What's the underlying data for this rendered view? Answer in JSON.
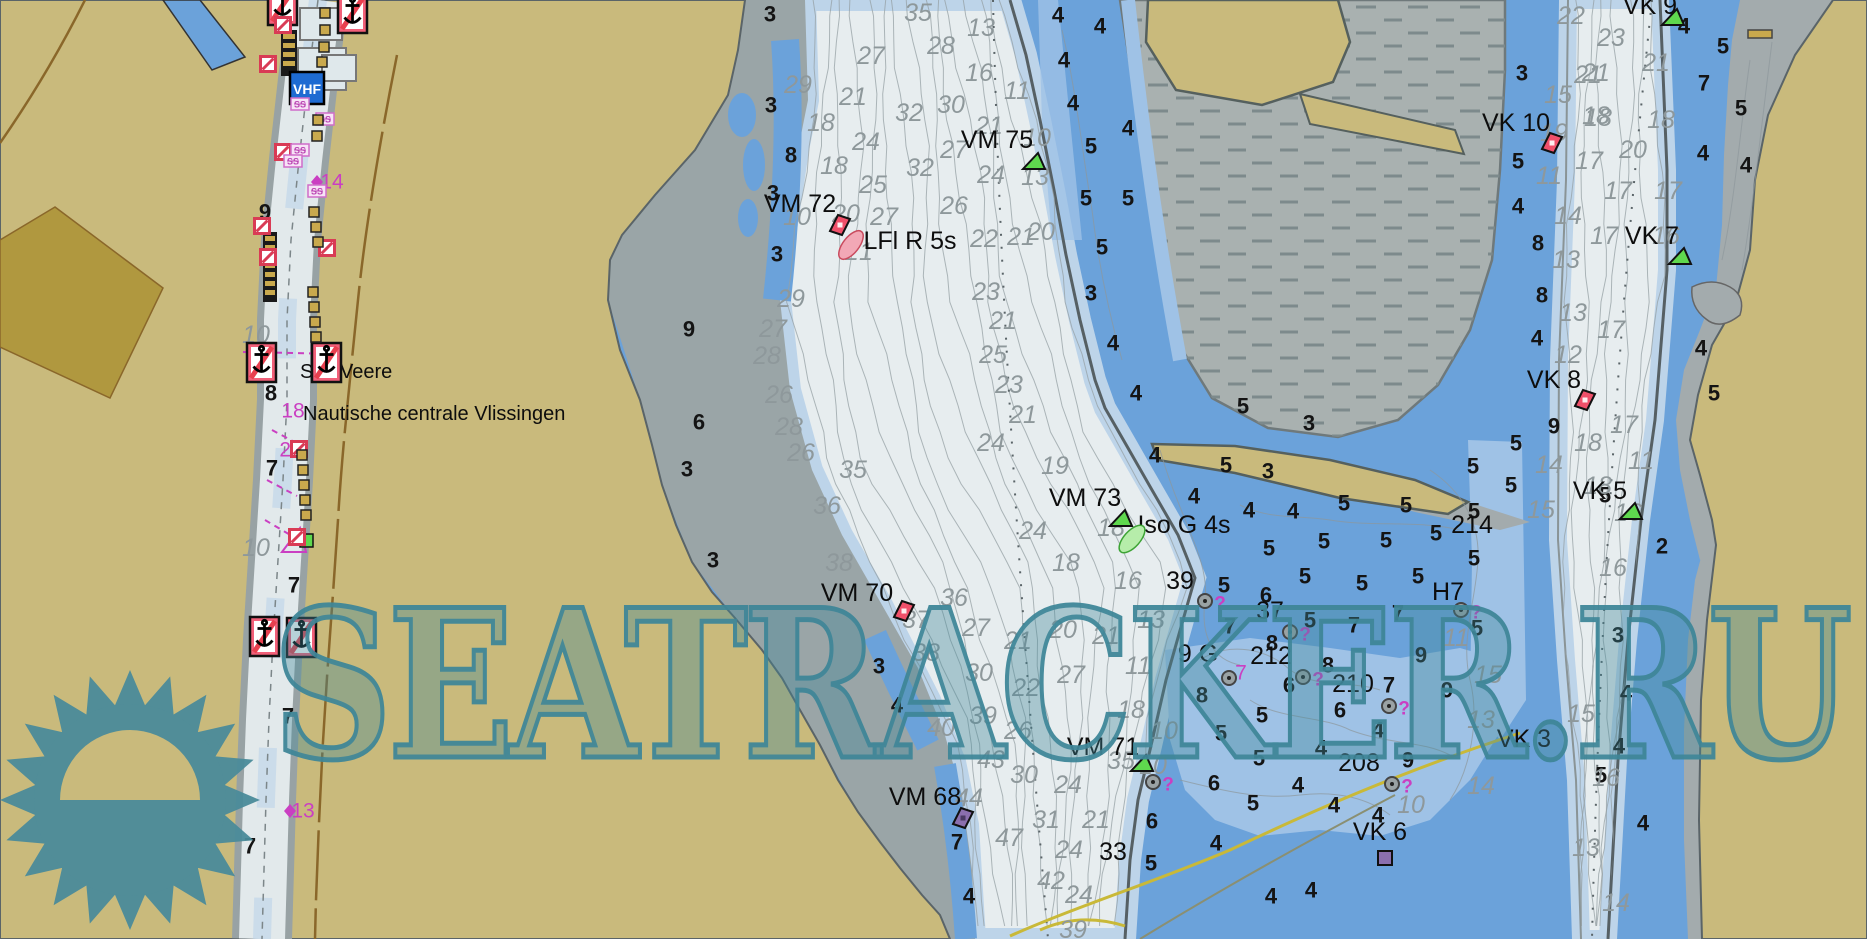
{
  "app": {
    "type": "nautical-chart-viewer"
  },
  "watermark": {
    "text": "SEATRACKER.RU",
    "color": "#3e8698"
  },
  "texts": {
    "vhf": "VHF",
    "ss": "SS"
  },
  "colors": {
    "land": "#c9ba7c",
    "land_dark": "#b0983f",
    "road": "#8a672a",
    "water_deep": "#e7edef",
    "water_shallow": "#6ba2da",
    "water_mid": "#9fc2e6",
    "water_light": "#bdd4e9",
    "flat_gray": "#a9b1b0",
    "bank_gray": "#9aa5a7",
    "magenta": "#ca3fc2",
    "buoy_red": "#f0506a",
    "buoy_green": "#5fd84e",
    "buoy_purple": "#8b6fae",
    "sign_red": "#f26079",
    "vhf_blue": "#1e6bd2",
    "gold": "#c9a94d",
    "teal": "#3e8698"
  },
  "nav_labels": [
    {
      "t": "VM 72",
      "x": 800,
      "y": 204
    },
    {
      "t": "LFl R 5s",
      "x": 910,
      "y": 241
    },
    {
      "t": "VM 75",
      "x": 997,
      "y": 140
    },
    {
      "t": "VM 73",
      "x": 1085,
      "y": 498
    },
    {
      "t": "Iso G 4s",
      "x": 1184,
      "y": 525
    },
    {
      "t": "VM 70",
      "x": 857,
      "y": 593
    },
    {
      "t": "VM 71",
      "x": 1103,
      "y": 747
    },
    {
      "t": "VM 68",
      "x": 925,
      "y": 797
    },
    {
      "t": "VK 10",
      "x": 1516,
      "y": 123
    },
    {
      "t": "VK 9",
      "x": 1650,
      "y": 6
    },
    {
      "t": "VK 7",
      "x": 1652,
      "y": 236
    },
    {
      "t": "VK 8",
      "x": 1554,
      "y": 380
    },
    {
      "t": "VK 5",
      "x": 1600,
      "y": 491
    },
    {
      "t": "VK 3",
      "x": 1524,
      "y": 739
    },
    {
      "t": "VK 6",
      "x": 1380,
      "y": 832
    },
    {
      "t": "H7",
      "x": 1448,
      "y": 592
    },
    {
      "t": "214",
      "x": 1472,
      "y": 525
    },
    {
      "t": "212",
      "x": 1271,
      "y": 656
    },
    {
      "t": "210",
      "x": 1353,
      "y": 684
    },
    {
      "t": "208",
      "x": 1359,
      "y": 763
    },
    {
      "t": "39",
      "x": 1180,
      "y": 581
    },
    {
      "t": "9 G",
      "x": 1198,
      "y": 654
    },
    {
      "t": "37",
      "x": 1270,
      "y": 611
    },
    {
      "t": "33",
      "x": 1113,
      "y": 852
    }
  ],
  "place_labels": [
    {
      "t": "Sas Veere",
      "x": 300,
      "y": 372
    },
    {
      "t": "Nautische centrale Vlissingen",
      "x": 303,
      "y": 414
    }
  ],
  "soundings_black": [
    [
      265,
      212,
      "9"
    ],
    [
      271,
      393,
      "8"
    ],
    [
      272,
      468,
      "7"
    ],
    [
      294,
      585,
      "7"
    ],
    [
      288,
      716,
      "7"
    ],
    [
      250,
      846,
      "7"
    ],
    [
      770,
      14,
      "3"
    ],
    [
      771,
      105,
      "3"
    ],
    [
      791,
      155,
      "8"
    ],
    [
      773,
      193,
      "3"
    ],
    [
      777,
      254,
      "3"
    ],
    [
      689,
      329,
      "9"
    ],
    [
      699,
      422,
      "6"
    ],
    [
      687,
      469,
      "3"
    ],
    [
      713,
      560,
      "3"
    ],
    [
      879,
      666,
      "3"
    ],
    [
      897,
      705,
      "4"
    ],
    [
      957,
      842,
      "7"
    ],
    [
      969,
      896,
      "4"
    ],
    [
      1058,
      15,
      "4"
    ],
    [
      1100,
      26,
      "4"
    ],
    [
      1064,
      60,
      "4"
    ],
    [
      1073,
      103,
      "4"
    ],
    [
      1128,
      128,
      "4"
    ],
    [
      1091,
      146,
      "5"
    ],
    [
      1086,
      198,
      "5"
    ],
    [
      1128,
      198,
      "5"
    ],
    [
      1102,
      247,
      "5"
    ],
    [
      1091,
      293,
      "3"
    ],
    [
      1113,
      343,
      "4"
    ],
    [
      1136,
      393,
      "4"
    ],
    [
      1155,
      455,
      "4"
    ],
    [
      1243,
      406,
      "5"
    ],
    [
      1309,
      423,
      "3"
    ],
    [
      1226,
      465,
      "5"
    ],
    [
      1268,
      471,
      "3"
    ],
    [
      1194,
      496,
      "4"
    ],
    [
      1249,
      510,
      "4"
    ],
    [
      1293,
      511,
      "4"
    ],
    [
      1344,
      503,
      "5"
    ],
    [
      1406,
      505,
      "5"
    ],
    [
      1473,
      466,
      "5"
    ],
    [
      1474,
      511,
      "5"
    ],
    [
      1436,
      533,
      "5"
    ],
    [
      1386,
      540,
      "5"
    ],
    [
      1324,
      541,
      "5"
    ],
    [
      1269,
      548,
      "5"
    ],
    [
      1305,
      576,
      "5"
    ],
    [
      1362,
      583,
      "5"
    ],
    [
      1418,
      576,
      "5"
    ],
    [
      1474,
      558,
      "5"
    ],
    [
      1224,
      585,
      "5"
    ],
    [
      1266,
      595,
      "6"
    ],
    [
      1310,
      620,
      "5"
    ],
    [
      1398,
      613,
      "7"
    ],
    [
      1354,
      625,
      "7"
    ],
    [
      1230,
      626,
      "7"
    ],
    [
      1477,
      628,
      "5"
    ],
    [
      1447,
      690,
      "9"
    ],
    [
      1202,
      695,
      "8"
    ],
    [
      1272,
      643,
      "8"
    ],
    [
      1328,
      665,
      "8"
    ],
    [
      1289,
      685,
      "6"
    ],
    [
      1262,
      715,
      "5"
    ],
    [
      1221,
      733,
      "5"
    ],
    [
      1259,
      758,
      "5"
    ],
    [
      1214,
      783,
      "6"
    ],
    [
      1253,
      803,
      "5"
    ],
    [
      1298,
      785,
      "4"
    ],
    [
      1321,
      748,
      "4"
    ],
    [
      1334,
      805,
      "4"
    ],
    [
      1340,
      710,
      "6"
    ],
    [
      1378,
      730,
      "4"
    ],
    [
      1389,
      685,
      "7"
    ],
    [
      1408,
      760,
      "9"
    ],
    [
      1421,
      655,
      "9"
    ],
    [
      1378,
      815,
      "4"
    ],
    [
      1152,
      821,
      "6"
    ],
    [
      1151,
      863,
      "5"
    ],
    [
      1216,
      843,
      "4"
    ],
    [
      1271,
      896,
      "4"
    ],
    [
      1311,
      890,
      "4"
    ],
    [
      1522,
      73,
      "3"
    ],
    [
      1518,
      161,
      "5"
    ],
    [
      1518,
      206,
      "4"
    ],
    [
      1538,
      243,
      "8"
    ],
    [
      1542,
      295,
      "8"
    ],
    [
      1537,
      338,
      "4"
    ],
    [
      1554,
      426,
      "9"
    ],
    [
      1516,
      443,
      "5"
    ],
    [
      1511,
      485,
      "5"
    ],
    [
      1605,
      495,
      "5"
    ],
    [
      1662,
      546,
      "2"
    ],
    [
      1618,
      635,
      "3"
    ],
    [
      1626,
      693,
      "4"
    ],
    [
      1619,
      746,
      "4"
    ],
    [
      1601,
      775,
      "5"
    ],
    [
      1643,
      823,
      "4"
    ],
    [
      1684,
      26,
      "4"
    ],
    [
      1723,
      46,
      "5"
    ],
    [
      1704,
      83,
      "7"
    ],
    [
      1741,
      108,
      "5"
    ],
    [
      1703,
      153,
      "4"
    ],
    [
      1746,
      165,
      "4"
    ],
    [
      1701,
      348,
      "4"
    ],
    [
      1714,
      393,
      "5"
    ]
  ],
  "soundings_gray": [
    [
      798,
      85,
      "29"
    ],
    [
      853,
      97,
      "21"
    ],
    [
      821,
      123,
      "18"
    ],
    [
      866,
      142,
      "24"
    ],
    [
      834,
      166,
      "18"
    ],
    [
      873,
      185,
      "25"
    ],
    [
      918,
      13,
      "35"
    ],
    [
      941,
      46,
      "28"
    ],
    [
      871,
      56,
      "27"
    ],
    [
      981,
      28,
      "13"
    ],
    [
      951,
      105,
      "30"
    ],
    [
      909,
      113,
      "32"
    ],
    [
      989,
      126,
      "21"
    ],
    [
      954,
      150,
      "27"
    ],
    [
      920,
      168,
      "32"
    ],
    [
      991,
      175,
      "24"
    ],
    [
      954,
      206,
      "26"
    ],
    [
      979,
      73,
      "16"
    ],
    [
      1017,
      91,
      "11"
    ],
    [
      1037,
      138,
      "10"
    ],
    [
      1035,
      177,
      "13"
    ],
    [
      1041,
      232,
      "20"
    ],
    [
      1021,
      237,
      "21"
    ],
    [
      984,
      239,
      "22"
    ],
    [
      846,
      214,
      "20"
    ],
    [
      884,
      217,
      "27"
    ],
    [
      859,
      252,
      "21"
    ],
    [
      797,
      217,
      "10"
    ],
    [
      791,
      299,
      "29"
    ],
    [
      773,
      329,
      "27"
    ],
    [
      767,
      356,
      "28"
    ],
    [
      779,
      395,
      "26"
    ],
    [
      789,
      427,
      "28"
    ],
    [
      801,
      453,
      "26"
    ],
    [
      986,
      292,
      "23"
    ],
    [
      1003,
      321,
      "21"
    ],
    [
      993,
      355,
      "25"
    ],
    [
      1009,
      385,
      "23"
    ],
    [
      1023,
      415,
      "21"
    ],
    [
      991,
      443,
      "24"
    ],
    [
      853,
      470,
      "35"
    ],
    [
      827,
      506,
      "36"
    ],
    [
      839,
      563,
      "38"
    ],
    [
      954,
      598,
      "36"
    ],
    [
      976,
      628,
      "27"
    ],
    [
      926,
      653,
      "38"
    ],
    [
      979,
      673,
      "30"
    ],
    [
      983,
      716,
      "39"
    ],
    [
      941,
      728,
      "40"
    ],
    [
      991,
      760,
      "43"
    ],
    [
      1024,
      775,
      "30"
    ],
    [
      969,
      798,
      "44"
    ],
    [
      1018,
      731,
      "26"
    ],
    [
      1026,
      688,
      "22"
    ],
    [
      1018,
      641,
      "21"
    ],
    [
      1063,
      630,
      "20"
    ],
    [
      1071,
      675,
      "27"
    ],
    [
      1106,
      636,
      "21"
    ],
    [
      1151,
      620,
      "13"
    ],
    [
      1131,
      710,
      "18"
    ],
    [
      1138,
      666,
      "11"
    ],
    [
      1164,
      731,
      "10"
    ],
    [
      1068,
      785,
      "24"
    ],
    [
      1121,
      761,
      "35"
    ],
    [
      1153,
      766,
      "10"
    ],
    [
      1046,
      820,
      "31"
    ],
    [
      1009,
      838,
      "47"
    ],
    [
      1096,
      820,
      "21"
    ],
    [
      1069,
      850,
      "24"
    ],
    [
      1051,
      881,
      "42"
    ],
    [
      1079,
      895,
      "24"
    ],
    [
      1073,
      930,
      "39"
    ],
    [
      1033,
      531,
      "24"
    ],
    [
      1066,
      563,
      "18"
    ],
    [
      1128,
      581,
      "16"
    ],
    [
      1055,
      466,
      "19"
    ],
    [
      1111,
      528,
      "18"
    ],
    [
      916,
      620,
      "37"
    ],
    [
      1588,
      75,
      "21"
    ],
    [
      1558,
      95,
      "15"
    ],
    [
      1596,
      116,
      "18"
    ],
    [
      1661,
      120,
      "18"
    ],
    [
      1554,
      133,
      "19"
    ],
    [
      1589,
      161,
      "17"
    ],
    [
      1633,
      150,
      "20"
    ],
    [
      1549,
      176,
      "11"
    ],
    [
      1618,
      191,
      "17"
    ],
    [
      1668,
      191,
      "17"
    ],
    [
      1568,
      216,
      "14"
    ],
    [
      1604,
      236,
      "17"
    ],
    [
      1666,
      236,
      "16"
    ],
    [
      1566,
      260,
      "13"
    ],
    [
      1571,
      16,
      "22"
    ],
    [
      1611,
      38,
      "23"
    ],
    [
      1656,
      63,
      "21"
    ],
    [
      1596,
      73,
      "21"
    ],
    [
      1598,
      118,
      "18"
    ],
    [
      1573,
      313,
      "13"
    ],
    [
      1611,
      330,
      "17"
    ],
    [
      1568,
      355,
      "12"
    ],
    [
      1588,
      443,
      "18"
    ],
    [
      1624,
      425,
      "17"
    ],
    [
      1549,
      465,
      "14"
    ],
    [
      1598,
      486,
      "18"
    ],
    [
      1641,
      461,
      "11"
    ],
    [
      1541,
      510,
      "15"
    ],
    [
      1628,
      513,
      "16"
    ],
    [
      1613,
      568,
      "16"
    ],
    [
      1581,
      714,
      "15"
    ],
    [
      1606,
      778,
      "16"
    ],
    [
      1586,
      848,
      "13"
    ],
    [
      1616,
      903,
      "14"
    ],
    [
      1456,
      638,
      "11"
    ],
    [
      1488,
      675,
      "15"
    ],
    [
      1481,
      720,
      "13"
    ],
    [
      1481,
      786,
      "14"
    ],
    [
      1411,
      805,
      "10"
    ],
    [
      256,
      335,
      "10"
    ],
    [
      256,
      548,
      "10"
    ]
  ],
  "magenta_marks": [
    {
      "t": "14",
      "x": 332,
      "y": 182
    },
    {
      "t": "18",
      "x": 293,
      "y": 411
    },
    {
      "t": "22",
      "x": 291,
      "y": 450
    },
    {
      "t": "13",
      "x": 303,
      "y": 811
    },
    {
      "t": "7",
      "x": 1241,
      "y": 673
    }
  ],
  "magenta_diamonds": [
    [
      317,
      182
    ],
    [
      290,
      811
    ]
  ],
  "buoys": [
    {
      "x": 840,
      "y": 225,
      "shape": "diamond",
      "color": "red",
      "tail": 38
    },
    {
      "x": 904,
      "y": 611,
      "shape": "diamond",
      "color": "red"
    },
    {
      "x": 1552,
      "y": 143,
      "shape": "diamond",
      "color": "red"
    },
    {
      "x": 1585,
      "y": 400,
      "shape": "diamond",
      "color": "red"
    },
    {
      "x": 1034,
      "y": 162,
      "shape": "triangle",
      "color": "green"
    },
    {
      "x": 1121,
      "y": 519,
      "shape": "triangle",
      "color": "green",
      "tail": 42
    },
    {
      "x": 1142,
      "y": 764,
      "shape": "triangle",
      "color": "green"
    },
    {
      "x": 1680,
      "y": 257,
      "shape": "triangle",
      "color": "green"
    },
    {
      "x": 1631,
      "y": 512,
      "shape": "triangle",
      "color": "green"
    },
    {
      "x": 1673,
      "y": 18,
      "shape": "triangle",
      "color": "green"
    },
    {
      "x": 963,
      "y": 818,
      "shape": "diamond",
      "color": "purple"
    },
    {
      "x": 1385,
      "y": 858,
      "shape": "square",
      "color": "purple"
    }
  ],
  "obstructions": [
    [
      1205,
      601,
      1
    ],
    [
      1229,
      678,
      0
    ],
    [
      1290,
      632,
      1
    ],
    [
      1303,
      677,
      1
    ],
    [
      1389,
      706,
      1
    ],
    [
      1392,
      784,
      1
    ],
    [
      1461,
      610,
      1
    ],
    [
      1153,
      782,
      1
    ]
  ],
  "anchor_signs": [
    [
      268,
      -14
    ],
    [
      338,
      -6
    ],
    [
      247,
      343
    ],
    [
      312,
      343
    ],
    [
      250,
      617
    ],
    [
      287,
      618
    ]
  ],
  "stripe_signs": [
    [
      283,
      25
    ],
    [
      268,
      64
    ],
    [
      283,
      152
    ],
    [
      262,
      226
    ],
    [
      268,
      257
    ],
    [
      327,
      248
    ],
    [
      299,
      449
    ],
    [
      297,
      537
    ]
  ],
  "ss_boxes": [
    [
      300,
      104
    ],
    [
      325,
      119
    ],
    [
      300,
      150
    ],
    [
      293,
      161
    ],
    [
      317,
      191
    ]
  ],
  "gold_squares": [
    [
      325,
      13
    ],
    [
      325,
      30
    ],
    [
      324,
      47
    ],
    [
      322,
      62
    ],
    [
      318,
      120
    ],
    [
      317,
      136
    ],
    [
      314,
      212
    ],
    [
      316,
      227
    ],
    [
      318,
      242
    ],
    [
      313,
      292
    ],
    [
      314,
      307
    ],
    [
      315,
      322
    ],
    [
      316,
      337
    ],
    [
      302,
      455
    ],
    [
      303,
      470
    ],
    [
      304,
      485
    ],
    [
      305,
      500
    ],
    [
      306,
      515
    ]
  ]
}
